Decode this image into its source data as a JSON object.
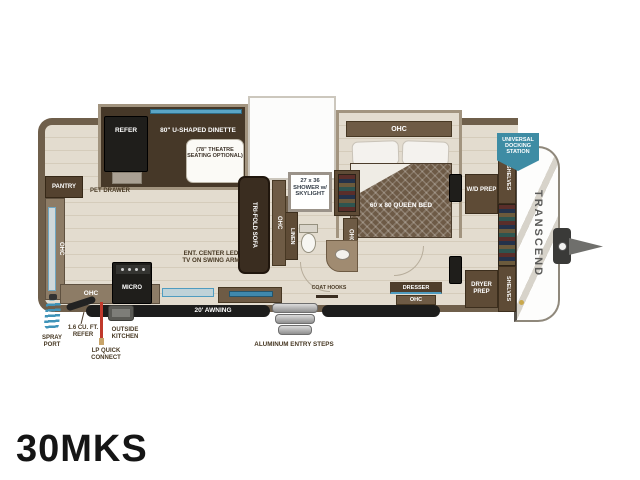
{
  "model": "30MKS",
  "brand": "TRANSCEND",
  "colors": {
    "wall": "#6f5f4b",
    "floor": "#e3dccf",
    "accent_blue": "#4f9cc0",
    "badge_blue": "#3e8ca4",
    "furniture_dark": "#3a2d20"
  },
  "slide1": {
    "refer": "REFER",
    "dinette": "80\" U-SHAPED DINETTE",
    "option": "(78\" THEATRE SEATING OPTIONAL)"
  },
  "kitchen": {
    "pantry": "PANTRY",
    "pet_drawer": "PET DRAWER",
    "ohc_wall": "OHC",
    "ohc_base": "OHC",
    "micro": "MICRO"
  },
  "living": {
    "sofa": "TRI-FOLD SOFA",
    "ohc": "OHC",
    "ent_center": "ENT. CENTER LED TV ON SWING ARM",
    "coat_hooks": "COAT HOOKS"
  },
  "bath": {
    "shower": "27 x 36 SHOWER w/ SKYLIGHT",
    "linen": "LINEN",
    "ohc": "OHC"
  },
  "bedroom": {
    "ohc": "OHC",
    "bed": "60 x 80 QUEEN BED",
    "dresser": "DRESSER",
    "dresser_ohc": "OHC",
    "wd_prep": "W/D PREP",
    "dryer_prep": "DRYER PREP",
    "shelves_top": "SHELVES",
    "shelves_bottom": "SHELVES"
  },
  "exterior": {
    "awning": "20' AWNING",
    "steps": "ALUMINUM ENTRY STEPS",
    "spray_port": "SPRAY PORT",
    "outside_refer": "1.6 CU. FT. REFER",
    "outside_kitchen": "OUTSIDE KITCHEN",
    "lp_connect": "LP QUICK CONNECT",
    "docking": "UNIVERSAL DOCKING STATION"
  }
}
